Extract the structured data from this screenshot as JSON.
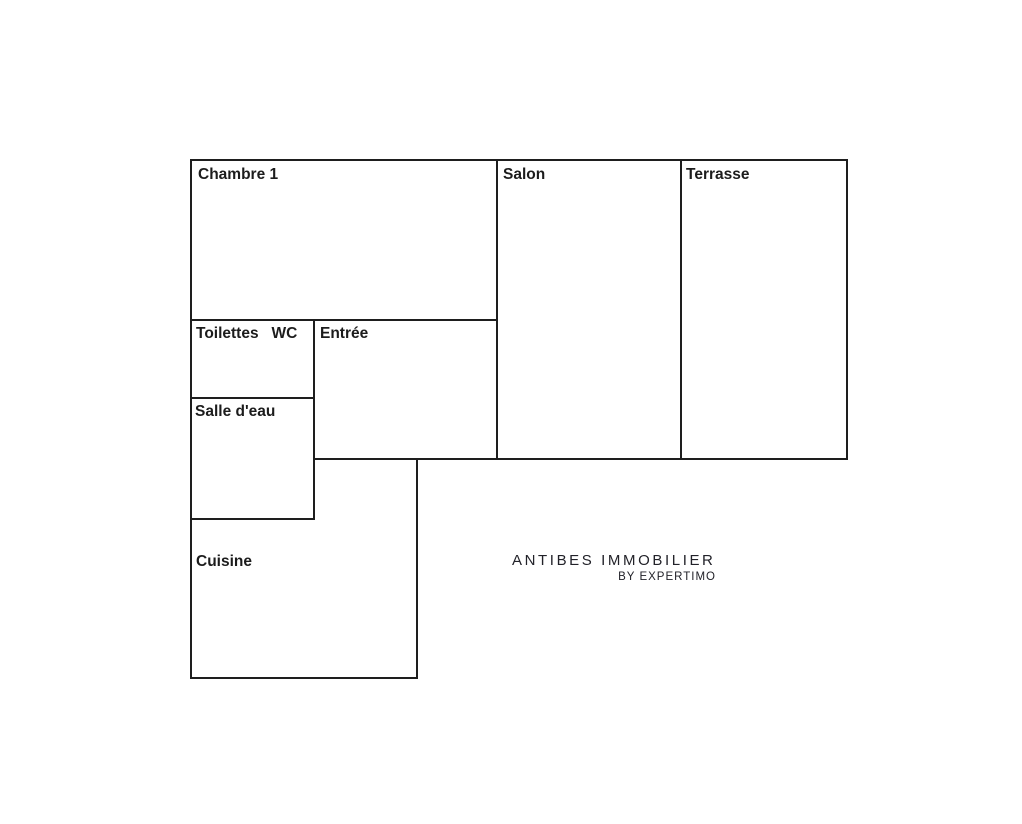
{
  "plan": {
    "background": "#ffffff",
    "wall_color": "#1e1e1e",
    "wall_width": 2,
    "label_color": "#1c1c1c",
    "walls": [
      {
        "x1": 191,
        "y1": 160,
        "x2": 847,
        "y2": 160
      },
      {
        "x1": 191,
        "y1": 160,
        "x2": 191,
        "y2": 678
      },
      {
        "x1": 847,
        "y1": 160,
        "x2": 847,
        "y2": 459
      },
      {
        "x1": 497,
        "y1": 160,
        "x2": 497,
        "y2": 459
      },
      {
        "x1": 681,
        "y1": 160,
        "x2": 681,
        "y2": 459
      },
      {
        "x1": 191,
        "y1": 320,
        "x2": 497,
        "y2": 320
      },
      {
        "x1": 314,
        "y1": 320,
        "x2": 314,
        "y2": 519
      },
      {
        "x1": 191,
        "y1": 398,
        "x2": 314,
        "y2": 398
      },
      {
        "x1": 314,
        "y1": 459,
        "x2": 847,
        "y2": 459
      },
      {
        "x1": 191,
        "y1": 519,
        "x2": 314,
        "y2": 519
      },
      {
        "x1": 417,
        "y1": 459,
        "x2": 417,
        "y2": 678
      },
      {
        "x1": 191,
        "y1": 678,
        "x2": 417,
        "y2": 678
      }
    ],
    "rooms": [
      {
        "id": "chambre-1",
        "label": "Chambre 1",
        "label_x": 198,
        "label_y": 165
      },
      {
        "id": "salon",
        "label": "Salon",
        "label_x": 503,
        "label_y": 165
      },
      {
        "id": "terrasse",
        "label": "Terrasse",
        "label_x": 686,
        "label_y": 165
      },
      {
        "id": "toilettes-wc",
        "label": "Toilettes   WC",
        "label_x": 196,
        "label_y": 324
      },
      {
        "id": "entree",
        "label": "Entrée",
        "label_x": 320,
        "label_y": 324
      },
      {
        "id": "salle-d-eau",
        "label": "Salle d'eau",
        "label_x": 195,
        "label_y": 402
      },
      {
        "id": "cuisine",
        "label": "Cuisine",
        "label_x": 196,
        "label_y": 552
      }
    ],
    "watermark": {
      "line1": "ANTIBES IMMOBILIER",
      "line2": "BY EXPERTIMO",
      "color": "#222229"
    }
  }
}
